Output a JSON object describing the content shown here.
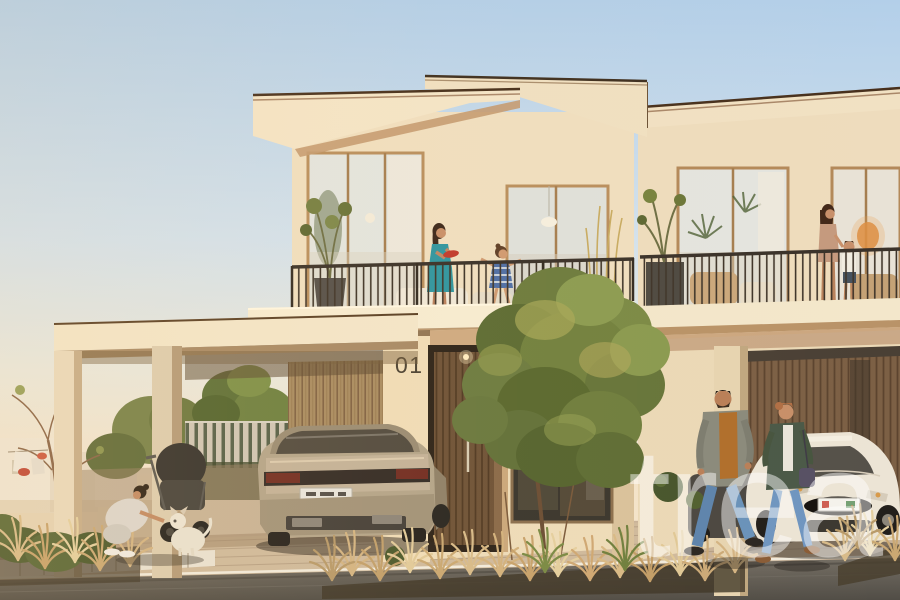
{
  "scene": {
    "description": "Golden-hour architectural rendering of modern two-storey townhouses with balconies, families, carport, parked cars and landscaped driveway",
    "house_number": "01",
    "watermark_text": "trea"
  },
  "palette": {
    "sky_top": "#b7d2ea",
    "sky_horizon": "#f4e4cb",
    "wall_sunlit": "#f0dfbe",
    "wall_shadow": "#c79f74",
    "roof_fascia": "#f3e5c8",
    "railing_dark": "#3a322a",
    "door_wood": "#6e5238",
    "timber_slats": "#a98c62",
    "foliage_green": "#6d7c3e",
    "grass_gold": "#d8bb8a",
    "pavement_tan": "#c8b298",
    "road_grey": "#5f5a52",
    "sedan_champagne": "#b4a58b",
    "white_car": "#ece4d5",
    "accent_red": "#c13a2c",
    "dress_teal": "#2f96a0"
  }
}
